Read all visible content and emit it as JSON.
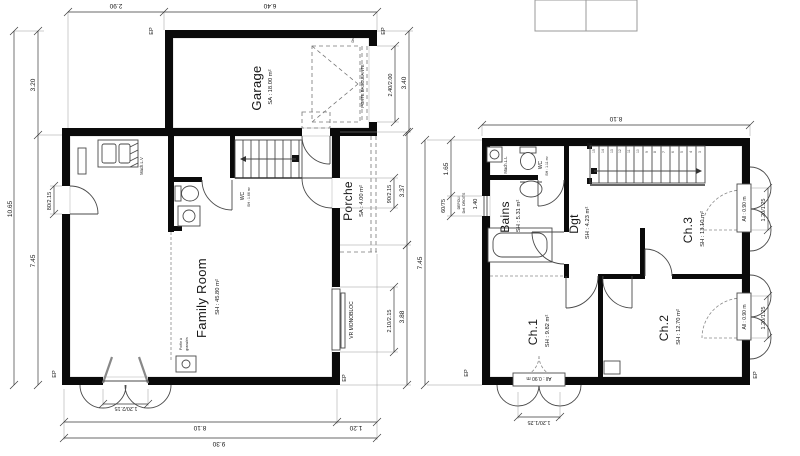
{
  "left": {
    "garage_name": "Garage",
    "garage_area": "SA : 18.00 m²",
    "porche_name": "Porche",
    "porche_area": "SA : 4.00 m²",
    "family_name": "Family Room",
    "family_area": "SH : 45.80 m²",
    "wc_name": "WC",
    "wc_area": "SH : 1.66 m²",
    "mach": "Mach.L.V",
    "poele_1": "Poêle à",
    "poele_2": "granulés",
    "vr": "VR MONOBLOC",
    "porte_basc": "PORTE BASCULANTE",
    "dsl": "Dsl",
    "ep": "EP",
    "d_top1": "2.90",
    "d_top2": "6.40",
    "d_l1": "3.20",
    "d_l2": "7.45",
    "d_l3": "10.65",
    "d_door_l": "80/2.15",
    "d_gdoor": "2.40/2.00",
    "d_gdepth": "3.40",
    "d_entry": "90/2.15",
    "d_porch": "3.37",
    "d_win": "2.10/2.15",
    "d_r2": "3.88",
    "d_ddoor": "1.20/2.15",
    "d_b1": "8.10",
    "d_b2": "1.20",
    "d_b3": "9.30"
  },
  "right": {
    "bains_name": "Bains",
    "bains_area": "SH : 5.31 m²",
    "dgt_name": "Dgt",
    "dgt_area": "SH : 4.23 m²",
    "wc_name": "WC",
    "wc_area": "SH : 1.11 m²",
    "ch1_name": "Ch.1",
    "ch1_area": "SH : 9.82 m²",
    "ch2_name": "Ch.2",
    "ch2_area": "SH : 12.70 m²",
    "ch3_name": "Ch.3",
    "ch3_area": "SH : 13.10 m²",
    "mach": "Mach.L.L",
    "depoli": "DEPOLI",
    "droits": "Def. DROITS",
    "allege": "All : 0.90 m",
    "ep": "EP",
    "d_top": "8.10",
    "d_l1": "1.65",
    "d_l2": "60/75",
    "d_l3": "1.40",
    "d_l4": "7.45",
    "d_win": "1.20/1.25",
    "stairs": [
      "15",
      "14",
      "13",
      "12",
      "11",
      "10",
      "9",
      "8",
      "7",
      "6",
      "5",
      "4",
      "3"
    ]
  },
  "colors": {
    "wall": "#0a0a0a",
    "line": "#4a4a4a",
    "roof_hatch": "#e0b4b4"
  }
}
